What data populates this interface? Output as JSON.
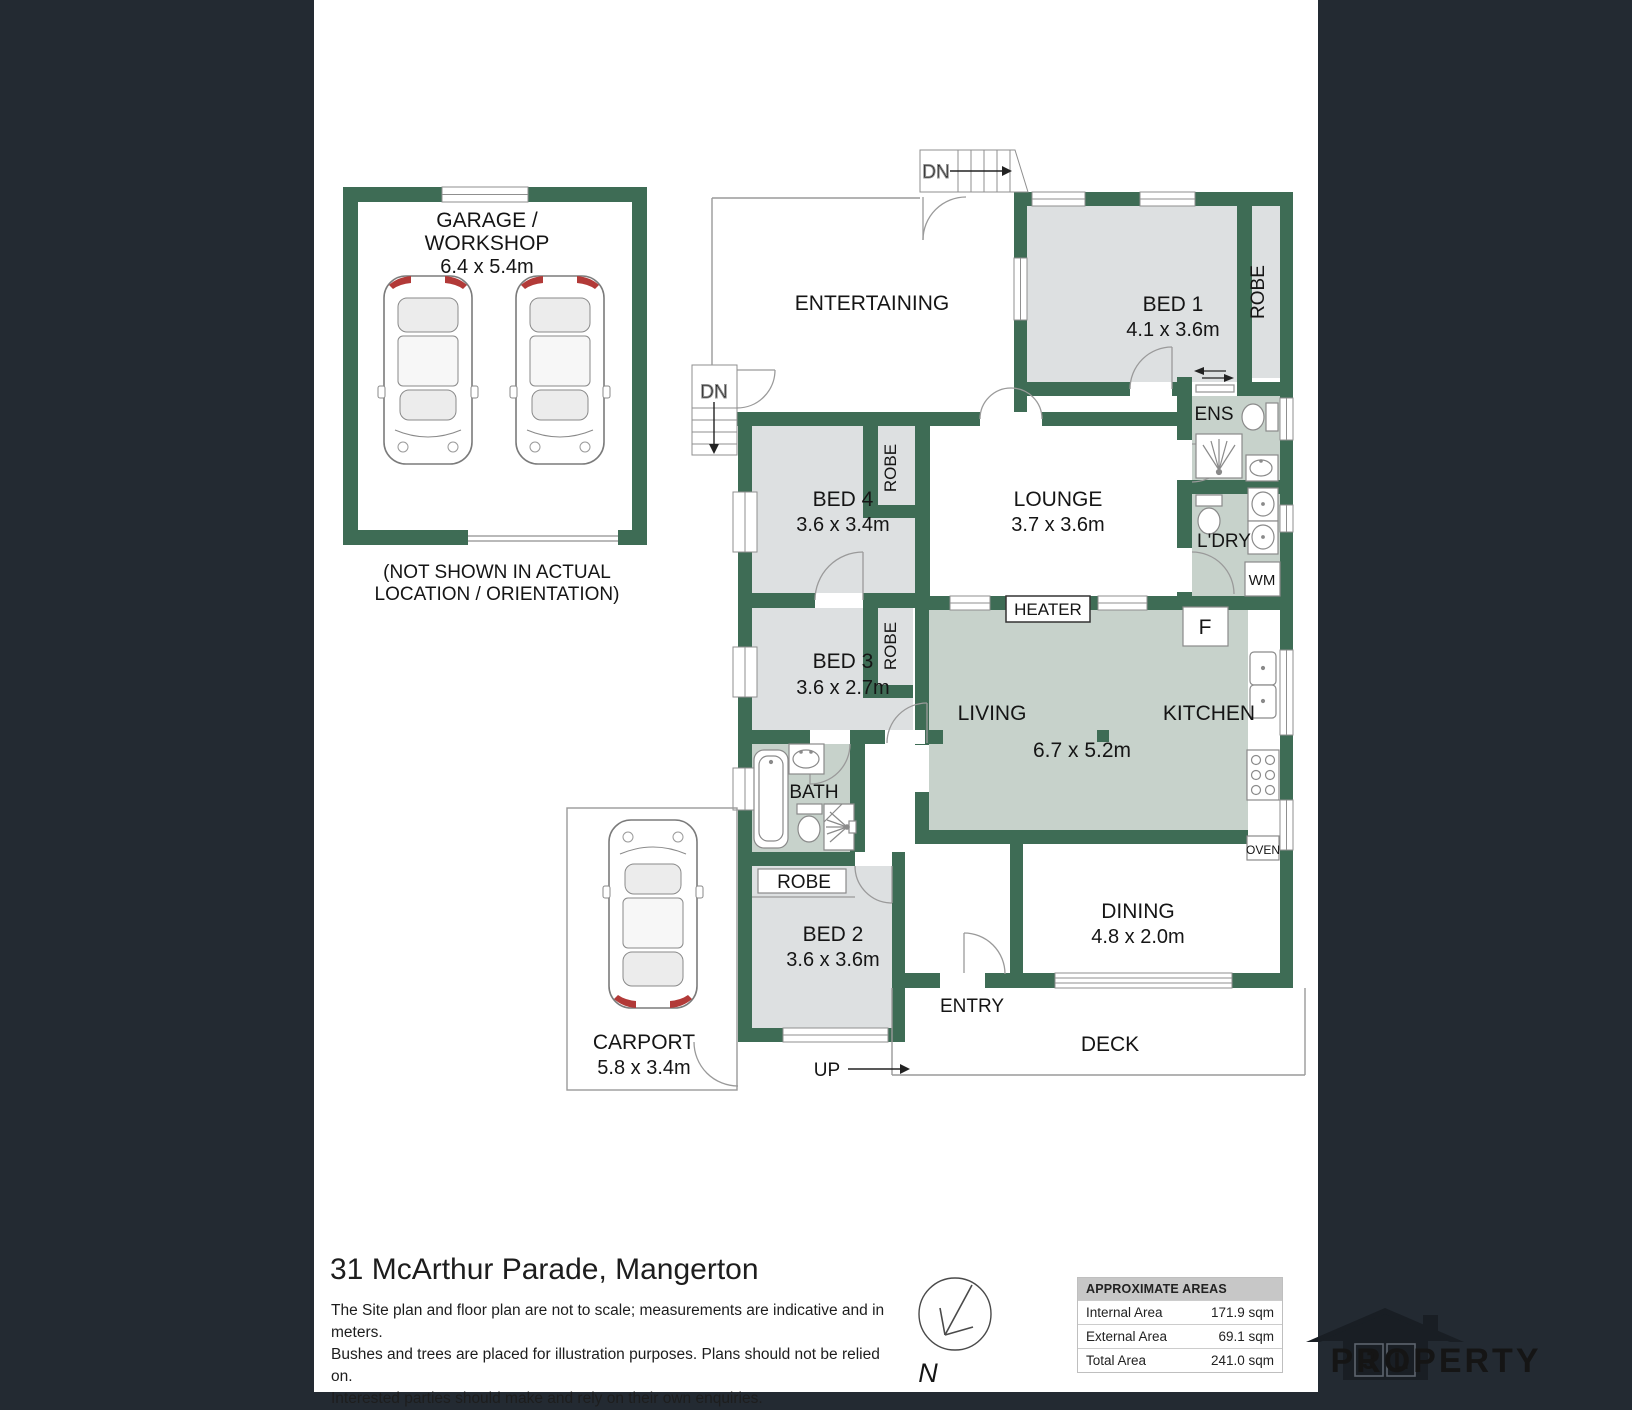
{
  "page": {
    "background_color": "#232A32",
    "canvas_color": "#FFFFFF"
  },
  "palette": {
    "wall": "#3E6C55",
    "room_gray": "#DDE0E1",
    "room_sage": "#C7D2CB",
    "accent_red": "#B23A38"
  },
  "plan": {
    "garage": {
      "label_line1": "GARAGE /",
      "label_line2": "WORKSHOP",
      "dims": "6.4 x 5.4m",
      "note_line1": "(NOT SHOWN IN ACTUAL",
      "note_line2": "LOCATION / ORIENTATION)"
    },
    "rooms": {
      "entertaining": {
        "name": "ENTERTAINING"
      },
      "bed1": {
        "name": "BED 1",
        "dims": "4.1 x 3.6m"
      },
      "bed2": {
        "name": "BED 2",
        "dims": "3.6 x 3.6m"
      },
      "bed3": {
        "name": "BED 3",
        "dims": "3.6 x 2.7m"
      },
      "bed4": {
        "name": "BED 4",
        "dims": "3.6 x 3.4m"
      },
      "lounge": {
        "name": "LOUNGE",
        "dims": "3.7 x 3.6m"
      },
      "living": {
        "name": "LIVING",
        "dims": "6.7 x 5.2m"
      },
      "kitchen": {
        "name": "KITCHEN"
      },
      "dining": {
        "name": "DINING",
        "dims": "4.8 x 2.0m"
      },
      "bath": {
        "name": "BATH"
      },
      "ens": {
        "name": "ENS"
      },
      "laundry": {
        "name": "L'DRY"
      },
      "entry": {
        "name": "ENTRY"
      },
      "deck": {
        "name": "DECK"
      },
      "carport": {
        "name": "CARPORT",
        "dims": "5.8 x 3.4m"
      }
    },
    "labels": {
      "robe": "ROBE",
      "wm": "WM",
      "heater": "HEATER",
      "fridge": "F",
      "oven": "OVEN",
      "up": "UP",
      "down": "DN"
    }
  },
  "footer": {
    "title": "31 McArthur Parade, Mangerton",
    "disclaimer_line1": "The Site plan and floor plan are not to scale; measurements are indicative and in meters.",
    "disclaimer_line2": "Bushes and trees are placed for illustration purposes. Plans should not be relied on.",
    "disclaimer_line3": "Interested parties should make and rely on their own enquiries.",
    "compass_label": "N"
  },
  "areas_table": {
    "header": "APPROXIMATE AREAS",
    "rows": [
      {
        "label": "Internal Area",
        "value": "171.9 sqm"
      },
      {
        "label": "External Area",
        "value": "69.1 sqm"
      },
      {
        "label": "Total Area",
        "value": "241.0 sqm"
      }
    ]
  },
  "brand": {
    "initial1": "J",
    "initial2": "L",
    "name": "PROPERTY"
  }
}
